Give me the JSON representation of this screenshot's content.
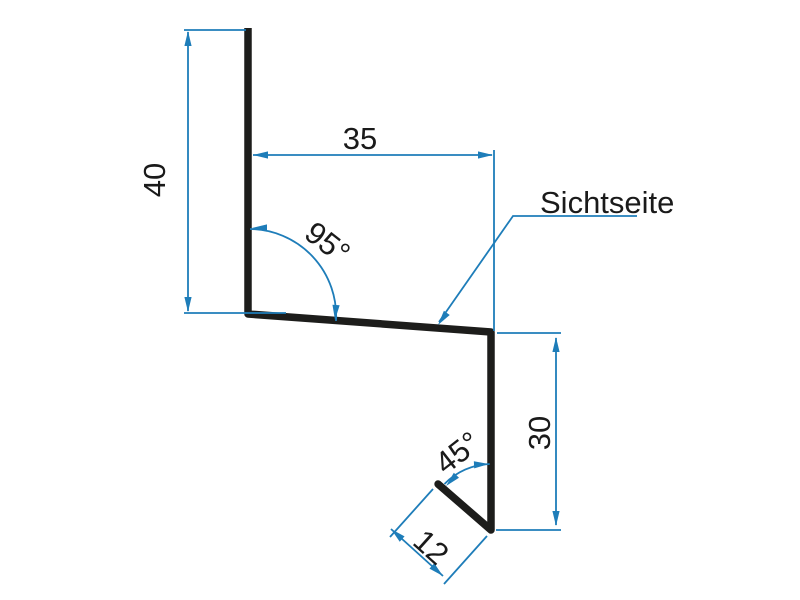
{
  "drawing": {
    "part_label": "Sichtseite",
    "dims": {
      "height_left": "40",
      "width_top": "35",
      "angle_upper": "95°",
      "height_right": "30",
      "angle_lower": "45°",
      "flange_length": "12"
    }
  },
  "colors": {
    "background": "#ffffff",
    "profile": "#1d1d1b",
    "dimension": "#1e7db9",
    "text": "#1a1a1a"
  }
}
